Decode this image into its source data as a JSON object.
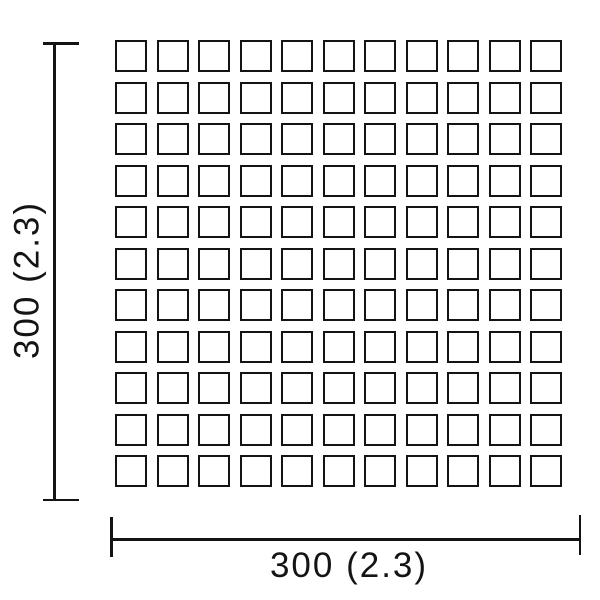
{
  "diagram": {
    "type": "dimension-drawing",
    "subject": "mosaic-tile-sheet",
    "grid": {
      "rows": 11,
      "cols": 11,
      "tile_shape": "square-outline"
    },
    "dimension_vertical": {
      "label": "300 (2.3)",
      "orientation": "rotated-90-ccw"
    },
    "dimension_horizontal": {
      "label": "300 (2.3)",
      "orientation": "horizontal"
    },
    "colors": {
      "line": "#141414",
      "background": "#ffffff"
    }
  }
}
